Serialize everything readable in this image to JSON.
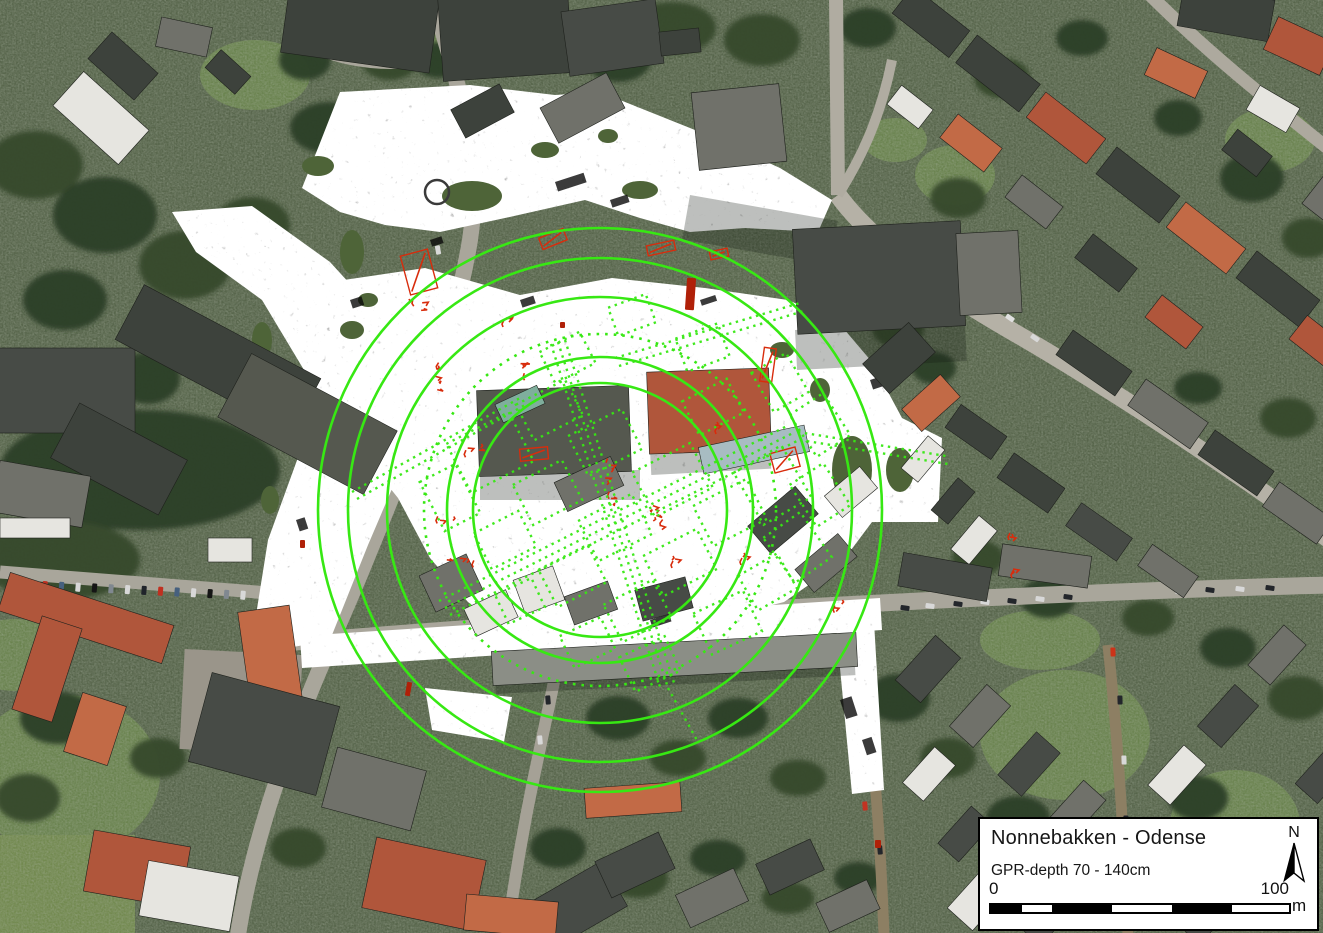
{
  "legend": {
    "title": "Nonnebakken - Odense",
    "subtitle": "GPR-depth 70 - 140cm",
    "scale": {
      "start_label": "0",
      "end_label": "100",
      "unit_label": "m",
      "segment_colors": [
        "#000000",
        "#ffffff",
        "#000000",
        "#ffffff",
        "#000000",
        "#ffffff"
      ],
      "segment_widths": [
        31,
        30,
        60,
        60,
        60,
        57
      ]
    },
    "north_label": "N"
  },
  "colors": {
    "overlay_green": "#37E813",
    "anomaly_red": "#D82C0C",
    "mosaic_base": "#e3e3e0",
    "legend_bg": "#ffffff",
    "legend_border": "#000000"
  },
  "overlay": {
    "rings": {
      "cx": 600,
      "cy": 510,
      "solid_radii": [
        282,
        252,
        213,
        153,
        127
      ],
      "dotted_radii": [
        176
      ],
      "stroke_width": 2.6
    },
    "ring_ditch_anomaly": {
      "cx": 437,
      "cy": 192,
      "r": 12
    },
    "gpr_mosaic_paths": [
      "M340,92 L470,85 L555,95 L600,92 L640,108 L715,138 L780,168 L832,200 L818,232 L745,228 L690,232 L640,218 L585,200 L505,218 L440,232 L385,225 L340,212 L302,188 L318,148 Z",
      "M172,212 L252,206 L330,262 L392,330 L420,400 L400,470 L368,545 L330,640 L288,648 L252,640 L268,540 L300,452 L310,380 L262,300 L196,252 Z",
      "M330,282 L425,268 L520,295 L612,278 L705,288 L788,300 L838,322 L872,362 L902,418 L942,438 L938,522 L872,522 L842,562 L784,602 L705,622 L612,640 L518,640 L468,602 L430,558 L398,498 L358,448 L338,382 Z",
      "M300,636 L880,598 L882,630 L302,668 Z",
      "M836,626 L874,622 L884,790 L852,794 Z",
      "M425,688 L512,697 L504,742 L432,730 Z"
    ],
    "structure_axes": [
      [
        445,
        608,
        795,
        432
      ],
      [
        450,
        615,
        801,
        439
      ],
      [
        439,
        601,
        789,
        425
      ],
      [
        558,
        342,
        668,
        688
      ],
      [
        565,
        340,
        675,
        686
      ],
      [
        551,
        344,
        661,
        690
      ],
      [
        352,
        492,
        520,
        398
      ],
      [
        357,
        499,
        525,
        405
      ],
      [
        615,
        358,
        800,
        303
      ],
      [
        619,
        366,
        804,
        311
      ],
      [
        798,
        432,
        946,
        456
      ],
      [
        800,
        440,
        948,
        464
      ],
      [
        668,
        688,
        698,
        742
      ]
    ],
    "structure_rects": [
      [
        455,
        425,
        70,
        55,
        -27
      ],
      [
        522,
        390,
        55,
        40,
        -27
      ],
      [
        575,
        420,
        60,
        45,
        -27
      ],
      [
        640,
        455,
        65,
        50,
        -27
      ],
      [
        700,
        490,
        60,
        45,
        -27
      ],
      [
        520,
        470,
        55,
        45,
        -27
      ],
      [
        585,
        505,
        60,
        45,
        -27
      ],
      [
        650,
        540,
        60,
        45,
        -27
      ],
      [
        480,
        520,
        50,
        40,
        -27
      ],
      [
        545,
        555,
        55,
        42,
        -27
      ],
      [
        610,
        590,
        55,
        42,
        -27
      ],
      [
        688,
        388,
        50,
        38,
        -27
      ],
      [
        745,
        455,
        55,
        60,
        -30
      ],
      [
        775,
        520,
        45,
        55,
        -35
      ],
      [
        700,
        600,
        55,
        45,
        -25
      ],
      [
        625,
        645,
        50,
        38,
        -25
      ],
      [
        430,
        470,
        40,
        55,
        -27
      ],
      [
        545,
        340,
        45,
        35,
        -27
      ],
      [
        612,
        300,
        40,
        30,
        -20
      ],
      [
        680,
        330,
        45,
        35,
        -20
      ],
      [
        760,
        360,
        40,
        45,
        -30
      ],
      [
        800,
        400,
        40,
        50,
        -33
      ],
      [
        800,
        470,
        40,
        50,
        -33
      ],
      [
        745,
        562,
        45,
        40,
        -30
      ],
      [
        565,
        625,
        45,
        35,
        -25
      ],
      [
        500,
        585,
        40,
        32,
        -25
      ]
    ],
    "anomalies": [
      {
        "x": 405,
        "y": 252,
        "w": 28,
        "h": 40,
        "rot": -15,
        "kind": "o"
      },
      {
        "x": 410,
        "y": 296,
        "w": 24,
        "h": 20,
        "rot": -15,
        "kind": "s"
      },
      {
        "x": 540,
        "y": 233,
        "w": 26,
        "h": 12,
        "rot": -22,
        "kind": "o"
      },
      {
        "x": 647,
        "y": 243,
        "w": 28,
        "h": 10,
        "rot": -12,
        "kind": "o"
      },
      {
        "x": 686,
        "y": 278,
        "w": 9,
        "h": 32,
        "rot": 4,
        "kind": "b"
      },
      {
        "x": 710,
        "y": 250,
        "w": 18,
        "h": 8,
        "rot": -12,
        "kind": "o"
      },
      {
        "x": 500,
        "y": 318,
        "w": 18,
        "h": 10,
        "rot": 0,
        "kind": "s"
      },
      {
        "x": 434,
        "y": 362,
        "w": 16,
        "h": 38,
        "rot": 5,
        "kind": "s"
      },
      {
        "x": 518,
        "y": 362,
        "w": 26,
        "h": 18,
        "rot": -10,
        "kind": "s"
      },
      {
        "x": 463,
        "y": 444,
        "w": 34,
        "h": 14,
        "rot": -5,
        "kind": "s"
      },
      {
        "x": 520,
        "y": 448,
        "w": 28,
        "h": 12,
        "rot": -5,
        "kind": "o"
      },
      {
        "x": 583,
        "y": 455,
        "w": 46,
        "h": 58,
        "rot": -8,
        "kind": "s"
      },
      {
        "x": 648,
        "y": 505,
        "w": 22,
        "h": 36,
        "rot": 10,
        "kind": "s"
      },
      {
        "x": 714,
        "y": 424,
        "w": 10,
        "h": 14,
        "rot": 0,
        "kind": "s"
      },
      {
        "x": 762,
        "y": 348,
        "w": 12,
        "h": 34,
        "rot": 8,
        "kind": "o"
      },
      {
        "x": 772,
        "y": 450,
        "w": 26,
        "h": 20,
        "rot": -15,
        "kind": "o"
      },
      {
        "x": 428,
        "y": 516,
        "w": 34,
        "h": 10,
        "rot": -3,
        "kind": "s"
      },
      {
        "x": 443,
        "y": 558,
        "w": 40,
        "h": 11,
        "rot": -3,
        "kind": "s"
      },
      {
        "x": 406,
        "y": 682,
        "w": 5,
        "h": 14,
        "rot": 10,
        "kind": "b"
      },
      {
        "x": 672,
        "y": 558,
        "w": 10,
        "h": 8,
        "rot": 0,
        "kind": "s"
      },
      {
        "x": 742,
        "y": 556,
        "w": 12,
        "h": 8,
        "rot": 0,
        "kind": "s"
      },
      {
        "x": 832,
        "y": 604,
        "w": 22,
        "h": 8,
        "rot": -4,
        "kind": "s"
      },
      {
        "x": 1010,
        "y": 533,
        "w": 8,
        "h": 10,
        "rot": 0,
        "kind": "s"
      },
      {
        "x": 1012,
        "y": 568,
        "w": 7,
        "h": 12,
        "rot": 0,
        "kind": "s"
      },
      {
        "x": 560,
        "y": 322,
        "w": 5,
        "h": 6,
        "rot": 0,
        "kind": "b"
      },
      {
        "x": 300,
        "y": 540,
        "w": 5,
        "h": 8,
        "rot": 0,
        "kind": "b"
      },
      {
        "x": 875,
        "y": 840,
        "w": 6,
        "h": 8,
        "rot": 0,
        "kind": "b"
      }
    ]
  }
}
